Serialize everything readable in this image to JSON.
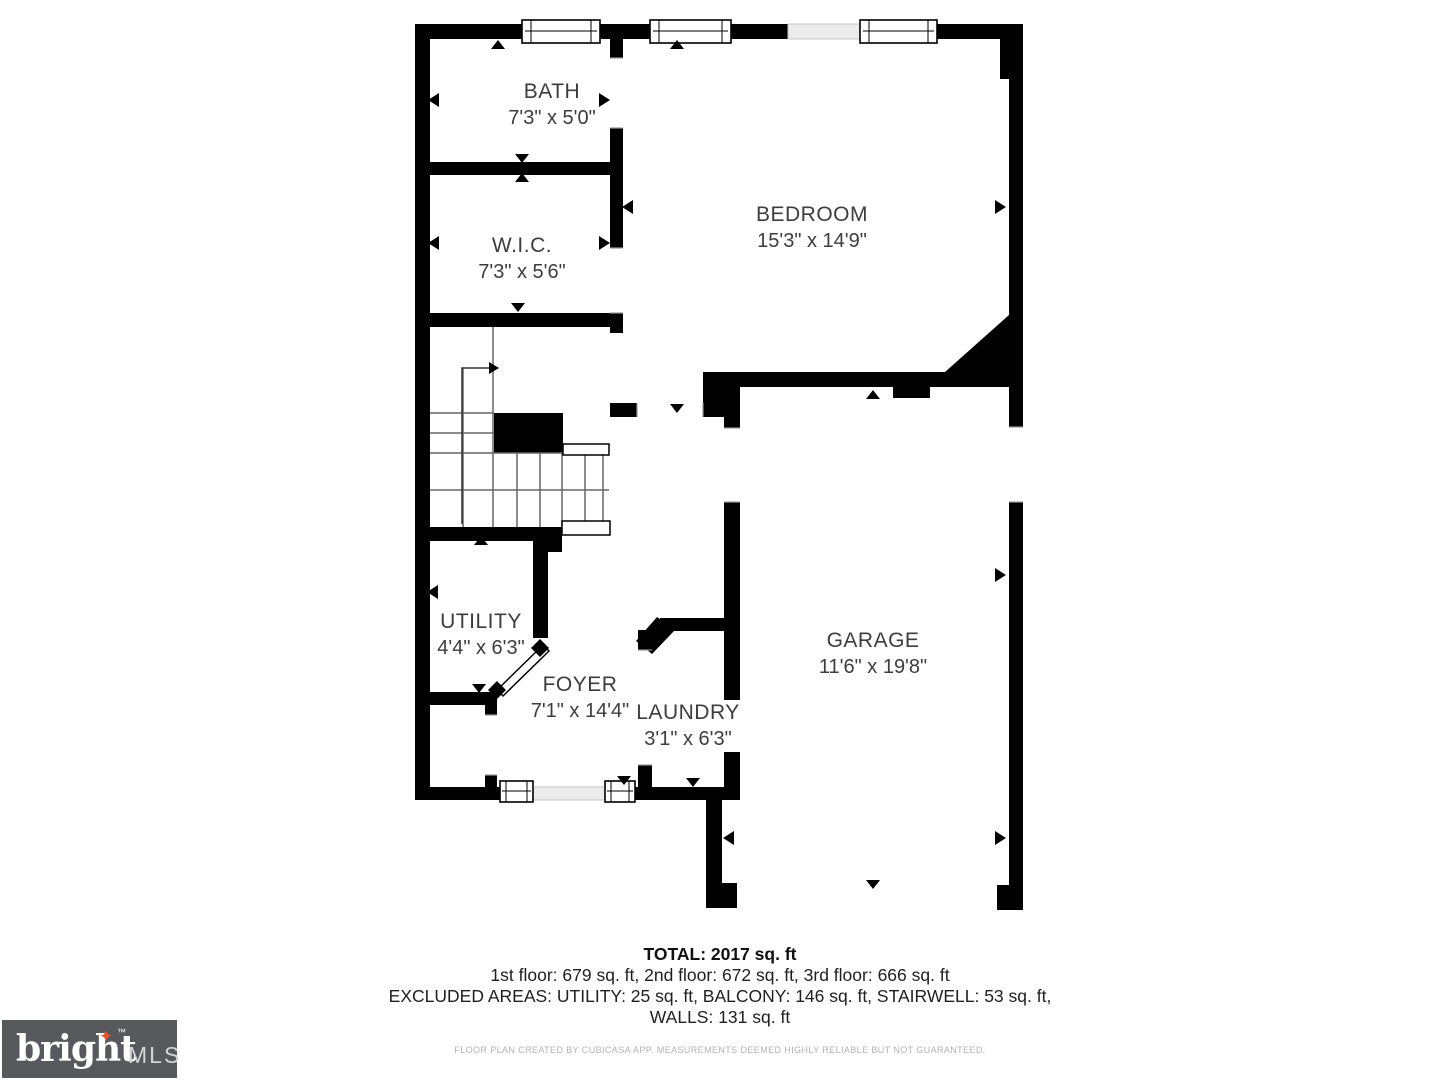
{
  "plan": {
    "rooms": [
      {
        "name": "BATH",
        "dims": "7'3\" x 5'0\""
      },
      {
        "name": "W.I.C.",
        "dims": "7'3\" x 5'6\""
      },
      {
        "name": "BEDROOM",
        "dims": "15'3\" x 14'9\""
      },
      {
        "name": "UTILITY",
        "dims": "4'4\" x 6'3\""
      },
      {
        "name": "FOYER",
        "dims": "7'1\" x 14'4\""
      },
      {
        "name": "LAUNDRY",
        "dims": "3'1\" x 6'3\""
      },
      {
        "name": "GARAGE",
        "dims": "11'6\" x 19'8\""
      }
    ],
    "wall_color": "#000000",
    "light_wall_color": "#ececec"
  },
  "summary": {
    "total": "TOTAL: 2017 sq. ft",
    "floors": "1st floor: 679 sq. ft, 2nd floor: 672 sq. ft, 3rd floor: 666 sq. ft",
    "excluded_line1": "EXCLUDED AREAS: UTILITY: 25 sq. ft, BALCONY: 146 sq. ft, STAIRWELL: 53 sq. ft,",
    "excluded_line2": "WALLS: 131 sq. ft",
    "disclaimer": "FLOOR PLAN CREATED BY CUBICASA APP. MEASUREMENTS DEEMED HIGHLY RELIABLE BUT NOT GUARANTEED."
  },
  "logo": {
    "brand": "bright",
    "star": "✦",
    "tm": "™",
    "suffix": "MLS",
    "bg_color": "#58595c",
    "star_color": "#e1562c"
  }
}
